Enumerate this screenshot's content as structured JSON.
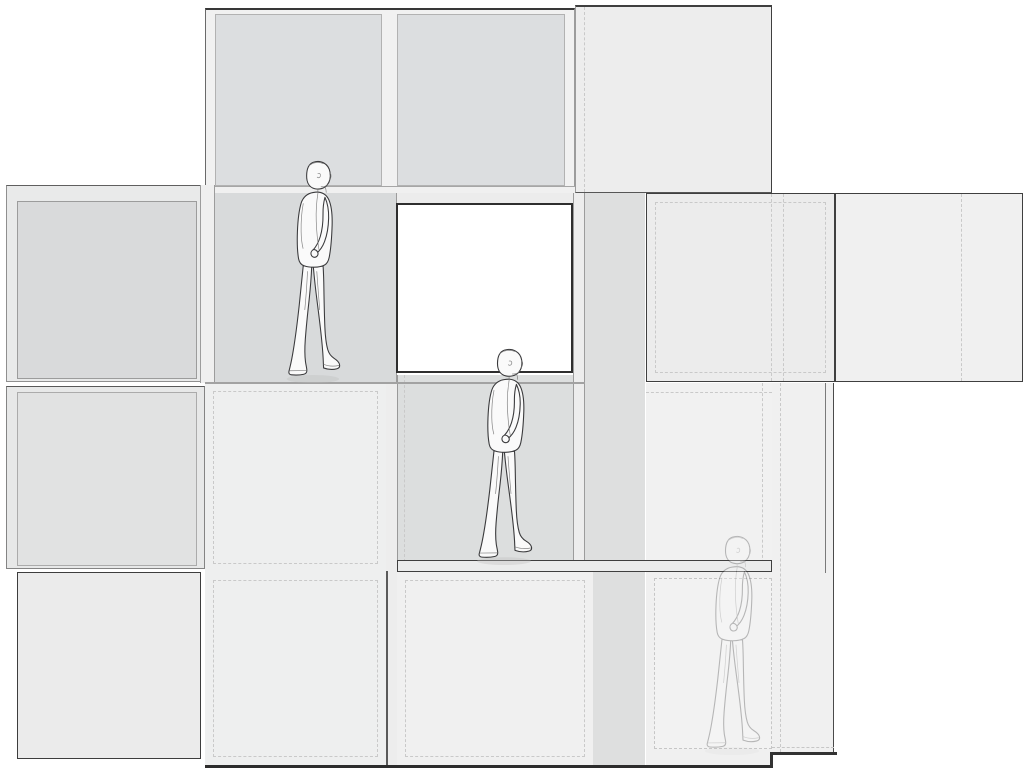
{
  "canvas": {
    "width": 1024,
    "height": 771,
    "background": "#ffffff"
  },
  "palette": {
    "line_dark": "#2e2e2e",
    "line_mid": "#9c9c9c",
    "dash": "#c9c9c9",
    "module_gray": "#dcdee0",
    "recess_gray": "#d8dadb",
    "panel_light": "#efefef",
    "void_white": "#ffffff",
    "figure_stroke": "#3a3a3c"
  },
  "panels": [
    {
      "id": "left-module-upper-outer",
      "x": 6,
      "y": 185,
      "w": 199,
      "h": 197,
      "fill": "#e9eaea",
      "border": "1px solid #8f8f8f",
      "bt": "1.5px solid #5f5f5f"
    },
    {
      "id": "left-module-upper-inner",
      "x": 17,
      "y": 201,
      "w": 180,
      "h": 178,
      "fill": "#d9dadb",
      "border": "1px solid #9c9c9c"
    },
    {
      "id": "left-module-middle-outer",
      "x": 6,
      "y": 386,
      "w": 199,
      "h": 183,
      "fill": "#e7e8e8",
      "border": "1px solid #848484",
      "bt": "1.5px solid #585858"
    },
    {
      "id": "left-module-middle-inner",
      "x": 17,
      "y": 392,
      "w": 180,
      "h": 174,
      "fill": "#e1e2e2",
      "border": "1px solid #ababab"
    },
    {
      "id": "left-module-lower",
      "x": 17,
      "y": 572,
      "w": 184,
      "h": 187,
      "fill": "#ebebeb",
      "border": "1.5px solid #3d3d3d"
    },
    {
      "id": "tower-roof-frame",
      "x": 205,
      "y": 8,
      "w": 370,
      "h": 185,
      "fill": "#f1f1f1",
      "bt": "2.5px solid #383838",
      "bl": "1.5px solid #6a6a6a",
      "br": "1px solid #9c9c9c",
      "bb": "1px solid #9c9c9c"
    },
    {
      "id": "tower-top-module-left",
      "x": 215,
      "y": 14,
      "w": 167,
      "h": 172,
      "fill": "#dcdee0",
      "border": "1px solid #b2b2b2"
    },
    {
      "id": "tower-top-module-right",
      "x": 397,
      "y": 14,
      "w": 168,
      "h": 172,
      "fill": "#dcdee0",
      "border": "1px solid #b2b2b2"
    },
    {
      "id": "top-right-module",
      "x": 575,
      "y": 5,
      "w": 197,
      "h": 188,
      "fill": "#ededed",
      "bt": "2px solid #3f3f3f",
      "br": "1.5px solid #3f3f3f",
      "bb": "1px solid #565656",
      "bl": "1px solid #9c9c9c",
      "dashV": [
        8
      ]
    },
    {
      "id": "tower-floor-band",
      "x": 205,
      "y": 186,
      "w": 370,
      "h": 11,
      "fill": "#f0f0f0",
      "bt": "1px solid #a6a6a6",
      "bb": "1px solid #a6a6a6"
    },
    {
      "id": "tower-left-frame-band",
      "x": 200,
      "y": 185,
      "w": 15,
      "h": 198,
      "fill": "#efefef",
      "bl": "1px solid #9c9c9c",
      "br": "1px solid #9c9c9c"
    },
    {
      "id": "tower-mid-module",
      "x": 215,
      "y": 193,
      "w": 182,
      "h": 189,
      "fill": "#d8dadb",
      "br": "1px solid #9c9c9c"
    },
    {
      "id": "strip-above-void",
      "x": 397,
      "y": 193,
      "w": 176,
      "h": 10,
      "fill": "#ececec"
    },
    {
      "id": "tower-right-frame-band",
      "x": 573,
      "y": 193,
      "w": 12,
      "h": 565,
      "fill": "#ededed",
      "bl": "1px solid #9c9c9c",
      "br": "1px solid #9c9c9c"
    },
    {
      "id": "recessed-column",
      "x": 585,
      "y": 193,
      "w": 60,
      "h": 572,
      "fill": "#dedfdf"
    },
    {
      "id": "right-module-a",
      "x": 646,
      "y": 193,
      "w": 189,
      "h": 189,
      "fill": "#ececec",
      "border": "1.5px solid #3f3f3f",
      "dashInset": 8,
      "dashV": [
        124,
        136
      ]
    },
    {
      "id": "right-module-b",
      "x": 835,
      "y": 193,
      "w": 188,
      "h": 189,
      "fill": "#f0f0f0",
      "border": "1.5px solid #3f3f3f",
      "dashV": [
        125
      ]
    },
    {
      "id": "lower-module-a",
      "x": 205,
      "y": 383,
      "w": 181,
      "h": 189,
      "fill": "#eeefef",
      "dashInset": 8
    },
    {
      "id": "central-gap-band",
      "x": 386,
      "y": 383,
      "w": 11,
      "h": 382,
      "fill": "#ededed"
    },
    {
      "id": "recessed-corridor",
      "x": 397,
      "y": 375,
      "w": 176,
      "h": 187,
      "fill": "#dcdede",
      "bl": "1px solid #999999",
      "dashV": [
        6
      ]
    },
    {
      "id": "row2-row3-divider-line",
      "x": 205,
      "y": 382,
      "w": 380,
      "h": 2,
      "fill": "#a2a2a2"
    },
    {
      "id": "void-module",
      "x": 396,
      "y": 203,
      "w": 177,
      "h": 170,
      "fill": "#ffffff",
      "border": "2px solid #2e2e2e"
    },
    {
      "id": "lower-module-b",
      "x": 646,
      "y": 383,
      "w": 126,
      "h": 190,
      "fill": "#f1f1f1",
      "dashV": [
        116
      ],
      "dashH": [
        9
      ]
    },
    {
      "id": "right-edge-block",
      "x": 772,
      "y": 383,
      "w": 62,
      "h": 371,
      "fill": "#f0f0f0",
      "br": "1.5px solid #4a4a4a",
      "bb": "2.5px solid #333333",
      "dashV": [
        8
      ]
    },
    {
      "id": "bottom-module-a",
      "x": 205,
      "y": 572,
      "w": 181,
      "h": 193,
      "fill": "#eeefef",
      "dashInset": 8
    },
    {
      "id": "bottom-module-b",
      "x": 397,
      "y": 572,
      "w": 196,
      "h": 193,
      "fill": "#f0f0f0",
      "dashInset": 8
    },
    {
      "id": "bottom-right-backdrop",
      "x": 646,
      "y": 572,
      "w": 126,
      "h": 193,
      "fill": "#f0f0f0"
    },
    {
      "id": "ghost-figure-panel",
      "x": 654,
      "y": 578,
      "w": 118,
      "h": 171,
      "fill": "#f2f2f2",
      "border": "1px dashed #c6c6c6"
    },
    {
      "id": "walkway-shelf",
      "x": 397,
      "y": 560,
      "w": 375,
      "h": 12,
      "fill": "#ebecec",
      "border": "1.5px solid #3f3f3f"
    },
    {
      "id": "bottom-module-divider-line",
      "x": 386,
      "y": 571,
      "w": 2,
      "h": 194,
      "fill": "#5a5a5a"
    },
    {
      "id": "right-inner-edge-line",
      "x": 825,
      "y": 383,
      "w": 1,
      "h": 190,
      "fill": "#7a7a7a"
    },
    {
      "id": "bottom-edge-central",
      "x": 205,
      "y": 765,
      "w": 567,
      "h": 3,
      "fill": "#2c2c2c"
    },
    {
      "id": "bottom-edge-right",
      "x": 770,
      "y": 752,
      "w": 67,
      "h": 3,
      "fill": "#333333"
    },
    {
      "id": "bottom-step-line",
      "x": 770,
      "y": 752,
      "w": 3,
      "h": 16,
      "fill": "#333333"
    },
    {
      "id": "bottom-dashed-line",
      "x": 772,
      "y": 747,
      "w": 62,
      "h": 1,
      "fill": "transparent",
      "bb": "1px dashed #c6c6c6"
    }
  ],
  "figures": [
    {
      "id": "walking-man-upper",
      "x": 280,
      "y": 159,
      "w": 62,
      "h": 225,
      "opacity": 1
    },
    {
      "id": "walking-man-middle",
      "x": 470,
      "y": 347,
      "w": 64,
      "h": 219,
      "opacity": 1
    },
    {
      "id": "walking-man-lower-ghost",
      "x": 698,
      "y": 534,
      "w": 64,
      "h": 222,
      "opacity": 0.32
    }
  ]
}
